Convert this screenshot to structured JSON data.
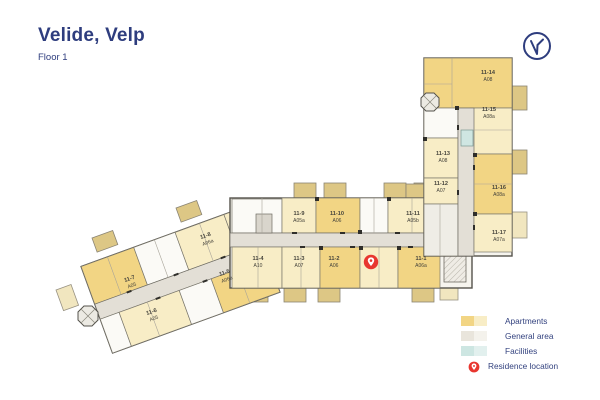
{
  "header": {
    "title": "Velide, Velp",
    "subtitle": "Floor 1"
  },
  "compass": {
    "name": "compass-north-reset"
  },
  "legend": [
    {
      "label": "Apartments",
      "kind": "apartments"
    },
    {
      "label": "General area",
      "kind": "general"
    },
    {
      "label": "Facilities",
      "kind": "facilities"
    },
    {
      "label": "Residence location",
      "kind": "residence-pin"
    }
  ],
  "colors": {
    "apartment_dark": "#f2d584",
    "apartment_light": "#f8edc6",
    "general_dark": "#e9e5dc",
    "general_light": "#f4f2ec",
    "facility_dark": "#cde6e2",
    "facility_light": "#e2f0ee",
    "pin_red": "#e8362f",
    "navy": "#2e3d7e"
  },
  "apartments": [
    {
      "id": "11-7",
      "code": "A05",
      "x": 131,
      "y": 283,
      "rot": -20,
      "shade": "dark"
    },
    {
      "id": "11-6",
      "code": "A05",
      "x": 153,
      "y": 316,
      "rot": -20,
      "shade": "light"
    },
    {
      "id": "11-8",
      "code": "A06a",
      "x": 207,
      "y": 240,
      "rot": -20,
      "shade": "light"
    },
    {
      "id": "11-5",
      "code": "A06a",
      "x": 226,
      "y": 277,
      "rot": -20,
      "shade": "dark"
    },
    {
      "id": "11-4",
      "code": "A10",
      "x": 258,
      "y": 263,
      "rot": 0,
      "shade": "light"
    },
    {
      "id": "11-3",
      "code": "A07",
      "x": 299,
      "y": 263,
      "rot": 0,
      "shade": "light"
    },
    {
      "id": "11-2",
      "code": "A06",
      "x": 334,
      "y": 263,
      "rot": 0,
      "shade": "dark"
    },
    {
      "id": "11-1",
      "code": "A06a",
      "x": 421,
      "y": 263,
      "rot": 0,
      "shade": "dark"
    },
    {
      "id": "11-9",
      "code": "A05a",
      "x": 299,
      "y": 218,
      "rot": 0,
      "shade": "light"
    },
    {
      "id": "11-10",
      "code": "A06",
      "x": 337,
      "y": 218,
      "rot": 0,
      "shade": "dark"
    },
    {
      "id": "11-11",
      "code": "A05b",
      "x": 413,
      "y": 218,
      "rot": 0,
      "shade": "light"
    },
    {
      "id": "11-14",
      "code": "A08",
      "x": 488,
      "y": 77,
      "rot": 0,
      "shade": "dark"
    },
    {
      "id": "11-15",
      "code": "A08a",
      "x": 489,
      "y": 114,
      "rot": 0,
      "shade": "light"
    },
    {
      "id": "11-13",
      "code": "A08",
      "x": 443,
      "y": 158,
      "rot": 0,
      "shade": "light"
    },
    {
      "id": "11-12",
      "code": "A07",
      "x": 441,
      "y": 188,
      "rot": 0,
      "shade": "light"
    },
    {
      "id": "11-16",
      "code": "A08a",
      "x": 499,
      "y": 192,
      "rot": 0,
      "shade": "dark"
    },
    {
      "id": "11-17",
      "code": "A07a",
      "x": 499,
      "y": 237,
      "rot": 0,
      "shade": "light"
    }
  ],
  "residence_pin": {
    "x": 371,
    "y": 262
  }
}
